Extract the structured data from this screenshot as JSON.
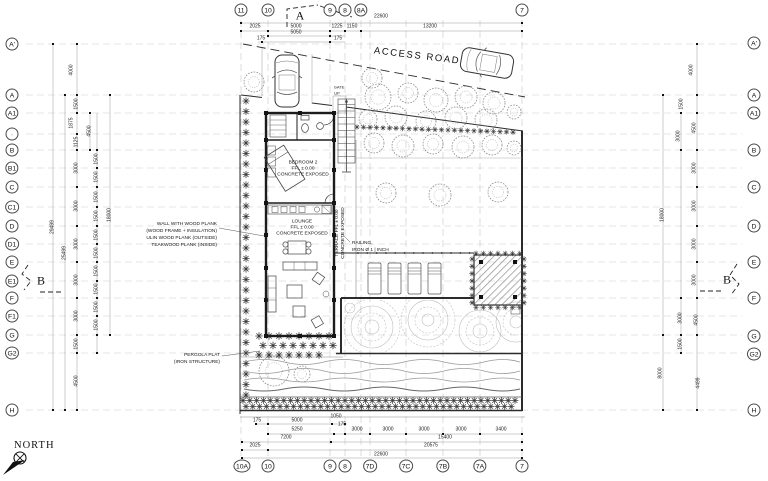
{
  "labels": {
    "north": "NORTH",
    "access_road": "ACCESS ROAD",
    "gate": "GATE",
    "up": "UP"
  },
  "rooms": {
    "bedroom2": {
      "name": "BEDROOM 2",
      "level": "FFL ± 0.00",
      "finish": "CONCRETE EXPOSED"
    },
    "lounge": {
      "name": "LOUNGE",
      "level": "FFL ± 0.00",
      "finish": "CONCRETE EXPOSED"
    },
    "terrace": {
      "line1": "TERRACE  FFL ± 0.00",
      "line2": "CONCRETE EXPOSED"
    }
  },
  "notes": {
    "wall": [
      "WALL WITH WOOD PLANK",
      "(WOOD FRAME + INSULATION)",
      "ULIN WOOD PLANK (OUTSIDE)",
      "TEAKWOOD PLANK (INSIDE)"
    ],
    "pergola": [
      "PERGOLA PLAT",
      "(IRON STRUCTURE)"
    ],
    "railing": [
      "RAILING,",
      "IRON Ø 1 | INCH"
    ]
  },
  "sections": {
    "top": "A",
    "left": "B",
    "right": "B"
  },
  "grid_bubbles": {
    "top": [
      {
        "label": "11",
        "x": 241
      },
      {
        "label": "10",
        "x": 268
      },
      {
        "label": "9",
        "x": 330
      },
      {
        "label": "8",
        "x": 345
      },
      {
        "label": "8A",
        "x": 361
      },
      {
        "label": "7",
        "x": 522
      }
    ],
    "bottom": [
      {
        "label": "10A",
        "x": 242
      },
      {
        "label": "10",
        "x": 268
      },
      {
        "label": "9",
        "x": 330
      },
      {
        "label": "8",
        "x": 345
      },
      {
        "label": "7D",
        "x": 370
      },
      {
        "label": "7C",
        "x": 406
      },
      {
        "label": "7B",
        "x": 443
      },
      {
        "label": "7A",
        "x": 480
      },
      {
        "label": "7",
        "x": 522
      }
    ],
    "left": [
      {
        "label": "A'",
        "y": 44
      },
      {
        "label": "A",
        "y": 95
      },
      {
        "label": "A1",
        "y": 113
      },
      {
        "label": "·",
        "y": 134
      },
      {
        "label": "B",
        "y": 150
      },
      {
        "label": "B1",
        "y": 168
      },
      {
        "label": "C",
        "y": 187
      },
      {
        "label": "C1",
        "y": 207
      },
      {
        "label": "D",
        "y": 226
      },
      {
        "label": "D1",
        "y": 244
      },
      {
        "label": "E",
        "y": 262
      },
      {
        "label": "E1",
        "y": 281
      },
      {
        "label": "F",
        "y": 298
      },
      {
        "label": "F1",
        "y": 316
      },
      {
        "label": "G",
        "y": 335
      },
      {
        "label": "G2",
        "y": 353
      },
      {
        "label": "H",
        "y": 410
      }
    ],
    "right": [
      {
        "label": "A'",
        "y": 43
      },
      {
        "label": "A",
        "y": 95
      },
      {
        "label": "A1",
        "y": 113
      },
      {
        "label": "B",
        "y": 150
      },
      {
        "label": "C",
        "y": 187
      },
      {
        "label": "D",
        "y": 226
      },
      {
        "label": "E",
        "y": 262
      },
      {
        "label": "F",
        "y": 298
      },
      {
        "label": "G",
        "y": 336
      },
      {
        "label": "G2",
        "y": 354
      },
      {
        "label": "H",
        "y": 410
      }
    ]
  },
  "dimensions": {
    "top": [
      {
        "v": "22600",
        "x": 381,
        "y": 17
      },
      {
        "v": "2025",
        "x": 255,
        "y": 27
      },
      {
        "v": "5000",
        "x": 296,
        "y": 27
      },
      {
        "v": "1225",
        "x": 337,
        "y": 27
      },
      {
        "v": "1150",
        "x": 352,
        "y": 27
      },
      {
        "v": "13200",
        "x": 430,
        "y": 27
      },
      {
        "v": "5050",
        "x": 296,
        "y": 33
      },
      {
        "v": "175",
        "x": 261,
        "y": 39
      },
      {
        "v": "175",
        "x": 338,
        "y": 39
      }
    ],
    "bottom": [
      {
        "v": "1050",
        "x": 336,
        "y": 417
      },
      {
        "v": "175",
        "x": 257,
        "y": 421
      },
      {
        "v": "5000",
        "x": 297,
        "y": 421
      },
      {
        "v": "175",
        "x": 342,
        "y": 425
      },
      {
        "v": "5250",
        "x": 297,
        "y": 430
      },
      {
        "v": "3000",
        "x": 357,
        "y": 430
      },
      {
        "v": "3000",
        "x": 388,
        "y": 430
      },
      {
        "v": "3000",
        "x": 424,
        "y": 430
      },
      {
        "v": "3000",
        "x": 461,
        "y": 430
      },
      {
        "v": "3400",
        "x": 501,
        "y": 430
      },
      {
        "v": "7200",
        "x": 286,
        "y": 438
      },
      {
        "v": "15400",
        "x": 445,
        "y": 438
      },
      {
        "v": "2025",
        "x": 255,
        "y": 446
      },
      {
        "v": "20575",
        "x": 431,
        "y": 446
      },
      {
        "v": "22600",
        "x": 381,
        "y": 455
      }
    ],
    "left": [
      {
        "v": "4000",
        "x": 72,
        "y": 70
      },
      {
        "v": "1500",
        "x": 77,
        "y": 104
      },
      {
        "v": "1875",
        "x": 72,
        "y": 123
      },
      {
        "v": "1125",
        "x": 77,
        "y": 142
      },
      {
        "v": "3000",
        "x": 77,
        "y": 168
      },
      {
        "v": "3000",
        "x": 77,
        "y": 206
      },
      {
        "v": "3000",
        "x": 77,
        "y": 244
      },
      {
        "v": "3000",
        "x": 77,
        "y": 280
      },
      {
        "v": "3000",
        "x": 77,
        "y": 316
      },
      {
        "v": "1500",
        "x": 77,
        "y": 344
      },
      {
        "v": "4500",
        "x": 77,
        "y": 381
      },
      {
        "v": "4500",
        "x": 90,
        "y": 131
      },
      {
        "v": "1500",
        "x": 97,
        "y": 159
      },
      {
        "v": "1500",
        "x": 97,
        "y": 177
      },
      {
        "v": "1500",
        "x": 97,
        "y": 197
      },
      {
        "v": "1500",
        "x": 97,
        "y": 216
      },
      {
        "v": "1500",
        "x": 97,
        "y": 235
      },
      {
        "v": "1500",
        "x": 97,
        "y": 253
      },
      {
        "v": "1500",
        "x": 97,
        "y": 271
      },
      {
        "v": "1500",
        "x": 97,
        "y": 289
      },
      {
        "v": "1500",
        "x": 97,
        "y": 307
      },
      {
        "v": "1500",
        "x": 97,
        "y": 325
      },
      {
        "v": "29499",
        "x": 53,
        "y": 227
      },
      {
        "v": "25499",
        "x": 65,
        "y": 253
      },
      {
        "v": "18000",
        "x": 110,
        "y": 215
      }
    ],
    "right": [
      {
        "v": "4000",
        "x": 692,
        "y": 70
      },
      {
        "v": "1500",
        "x": 682,
        "y": 104
      },
      {
        "v": "4500",
        "x": 695,
        "y": 128
      },
      {
        "v": "3000",
        "x": 679,
        "y": 136
      },
      {
        "v": "3000",
        "x": 695,
        "y": 168
      },
      {
        "v": "3000",
        "x": 695,
        "y": 206
      },
      {
        "v": "3000",
        "x": 695,
        "y": 244
      },
      {
        "v": "3000",
        "x": 695,
        "y": 280
      },
      {
        "v": "3000",
        "x": 681,
        "y": 318
      },
      {
        "v": "4500",
        "x": 697,
        "y": 320
      },
      {
        "v": "1500",
        "x": 681,
        "y": 344
      },
      {
        "v": "4499",
        "x": 699,
        "y": 383
      },
      {
        "v": "18000",
        "x": 663,
        "y": 215
      },
      {
        "v": "8000",
        "x": 661,
        "y": 373
      }
    ]
  }
}
